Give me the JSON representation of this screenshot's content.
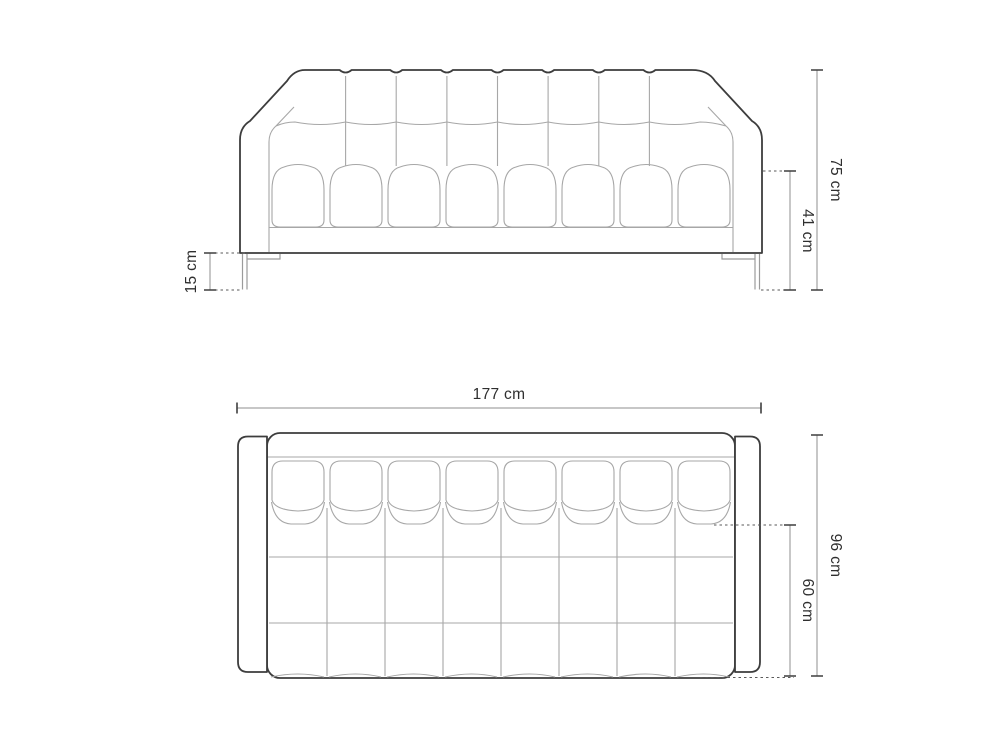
{
  "diagram": {
    "front_view": {
      "dims": {
        "overall_height": "75 cm",
        "seat_height": "41 cm",
        "leg_height": "15 cm"
      }
    },
    "top_view": {
      "dims": {
        "overall_width": "177 cm",
        "overall_depth": "96 cm",
        "seat_depth": "60 cm"
      }
    },
    "colors": {
      "background": "#ffffff",
      "outline": "#3d3d3d",
      "seam": "#a7a7a7",
      "dimension_line": "#8f8f8f",
      "dimension_tick": "#3f3f3f",
      "extension_line": "#5a5a5a",
      "text": "#2f2f2f"
    }
  }
}
